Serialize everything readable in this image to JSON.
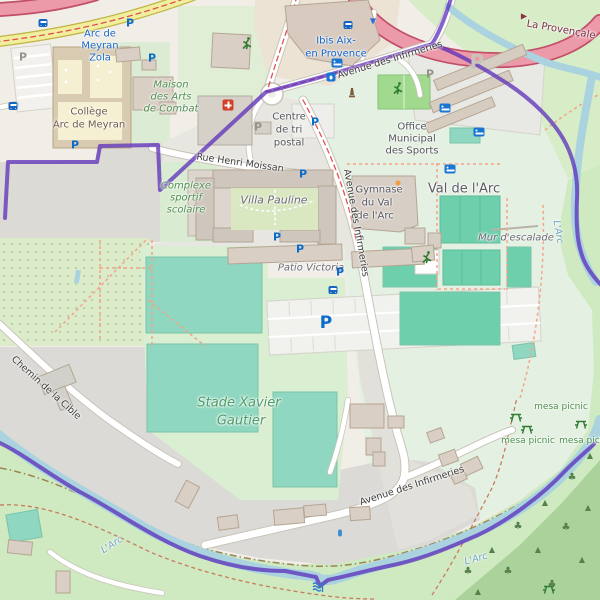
{
  "map": {
    "type": "openstreetmap-view",
    "colors": {
      "boundary_purple": "#5b2eba",
      "water_blue": "#aad3df",
      "pitch_teal": "#8fd7c0",
      "court_teal": "#6ecfac",
      "motorway_pink": "#ec9aa9",
      "secondary_yellow": "#f1ef9e",
      "grass_green": "#cfe9c1",
      "forest_green": "#abd29b",
      "paved_gray": "#dbdad6"
    },
    "labels": [
      {
        "name": "transit-stop-arc-de-meyran-1",
        "cls": "transit",
        "text": "Arc de",
        "x": 100,
        "y": 34
      },
      {
        "name": "transit-stop-arc-de-meyran-2",
        "cls": "transit",
        "text": "Meyran",
        "x": 100,
        "y": 46
      },
      {
        "name": "transit-stop-arc-de-meyran-3",
        "cls": "transit",
        "text": "Zola",
        "x": 100,
        "y": 58
      },
      {
        "name": "label-college-1",
        "cls": "poi",
        "text": "Collège",
        "x": 89,
        "y": 112
      },
      {
        "name": "label-college-2",
        "cls": "poi",
        "text": "Arc de Meyran",
        "x": 89,
        "y": 125
      },
      {
        "name": "label-maison-arts-1",
        "cls": "leisure",
        "text": "Maison",
        "x": 171,
        "y": 85
      },
      {
        "name": "label-maison-arts-2",
        "cls": "leisure",
        "text": "des Arts",
        "x": 171,
        "y": 97
      },
      {
        "name": "label-maison-arts-3",
        "cls": "leisure",
        "text": "de Combat",
        "x": 171,
        "y": 109
      },
      {
        "name": "label-hotel-ibis-1",
        "cls": "tourism",
        "text": "Ibis Aix-",
        "x": 336,
        "y": 41
      },
      {
        "name": "label-hotel-ibis-2",
        "cls": "tourism",
        "text": "en Provence",
        "x": 336,
        "y": 54
      },
      {
        "name": "street-avenue-infirmeries-north",
        "cls": "street",
        "text": "Avenue des Infirmeries",
        "x": 390,
        "y": 60,
        "rot": -17
      },
      {
        "name": "label-centre-tri-1",
        "cls": "place",
        "text": "Centre",
        "x": 289,
        "y": 117
      },
      {
        "name": "label-centre-tri-2",
        "cls": "place",
        "text": "de tri",
        "x": 289,
        "y": 130
      },
      {
        "name": "label-centre-tri-3",
        "cls": "place",
        "text": "postal",
        "x": 289,
        "y": 143
      },
      {
        "name": "label-office-sports-1",
        "cls": "place",
        "text": "Office",
        "x": 412,
        "y": 127
      },
      {
        "name": "label-office-sports-2",
        "cls": "place",
        "text": "Municipal",
        "x": 412,
        "y": 139
      },
      {
        "name": "label-office-sports-3",
        "cls": "place",
        "text": "des Sports",
        "x": 412,
        "y": 151
      },
      {
        "name": "street-rue-henri-moissan",
        "cls": "street",
        "text": "Rue Henri Moissan",
        "x": 240,
        "y": 163,
        "rot": 8
      },
      {
        "name": "label-complexe-1",
        "cls": "leisure",
        "text": "Complexe",
        "x": 186,
        "y": 186
      },
      {
        "name": "label-complexe-2",
        "cls": "leisure",
        "text": "sportif",
        "x": 186,
        "y": 198
      },
      {
        "name": "label-complexe-3",
        "cls": "leisure",
        "text": "scolaire",
        "x": 186,
        "y": 210
      },
      {
        "name": "label-villa-pauline",
        "cls": "residential",
        "text": "Villa Pauline",
        "x": 274,
        "y": 200,
        "size": 11
      },
      {
        "name": "label-gymnase-1",
        "cls": "place",
        "text": "Gymnase",
        "x": 379,
        "y": 190
      },
      {
        "name": "label-gymnase-2",
        "cls": "place",
        "text": "du Val",
        "x": 377,
        "y": 203
      },
      {
        "name": "label-gymnase-3",
        "cls": "place",
        "text": "de l'Arc",
        "x": 375,
        "y": 216
      },
      {
        "name": "label-val-de-larc",
        "cls": "district",
        "text": "Val de l'Arc",
        "x": 464,
        "y": 189
      },
      {
        "name": "label-mur-escalade",
        "cls": "residential",
        "text": "Mur d'escalade",
        "x": 516,
        "y": 238
      },
      {
        "name": "label-patio-victoria",
        "cls": "residential",
        "text": "Patio Victoria",
        "x": 311,
        "y": 268
      },
      {
        "name": "street-avenue-infirmeries-mid",
        "cls": "street",
        "text": "Avenue des Infirmeries",
        "x": 356,
        "y": 223,
        "rot": 80
      },
      {
        "name": "label-stade-1",
        "cls": "stade",
        "text": "Stade Xavier",
        "x": 239,
        "y": 403
      },
      {
        "name": "label-stade-2",
        "cls": "stade",
        "text": "Gautier",
        "x": 241,
        "y": 421
      },
      {
        "name": "label-picnic-1",
        "cls": "picnic",
        "text": "mesa picnic",
        "x": 561,
        "y": 407
      },
      {
        "name": "label-picnic-2",
        "cls": "picnic",
        "text": "mesa picnic",
        "x": 528,
        "y": 441
      },
      {
        "name": "label-picnic-3",
        "cls": "picnic",
        "text": "mesa picnic",
        "x": 586,
        "y": 441
      },
      {
        "name": "street-chemin-de-la-cible",
        "cls": "street",
        "text": "Chemin de la Cible",
        "x": 46,
        "y": 388,
        "rot": 42
      },
      {
        "name": "label-river-larc-1",
        "cls": "water",
        "text": "L'Arc",
        "x": 112,
        "y": 545,
        "rot": -33
      },
      {
        "name": "label-river-larc-2",
        "cls": "water",
        "text": "L'Arc",
        "x": 476,
        "y": 559,
        "rot": -16
      },
      {
        "name": "label-river-larc-3",
        "cls": "water",
        "text": "L'Arc",
        "x": 558,
        "y": 232,
        "rot": 80
      },
      {
        "name": "street-avenue-infirmeries-south",
        "cls": "street",
        "text": "Avenue des Infirmeries",
        "x": 412,
        "y": 486,
        "rot": -18
      },
      {
        "name": "street-la-provencale",
        "cls": "motorway",
        "text": "La Provençale",
        "x": 561,
        "y": 30,
        "rot": 10
      }
    ],
    "icons": [
      {
        "name": "parking-icon",
        "type": "p",
        "x": 130,
        "y": 23
      },
      {
        "name": "parking-icon",
        "type": "p",
        "x": 152,
        "y": 58
      },
      {
        "name": "parking-icon",
        "type": "p",
        "x": 75,
        "y": 145
      },
      {
        "name": "parking-icon",
        "type": "p",
        "x": 315,
        "y": 122
      },
      {
        "name": "parking-icon",
        "type": "p",
        "x": 303,
        "y": 174
      },
      {
        "name": "parking-icon",
        "type": "p",
        "x": 277,
        "y": 237
      },
      {
        "name": "parking-icon",
        "type": "p",
        "x": 300,
        "y": 249
      },
      {
        "name": "parking-icon",
        "type": "p",
        "x": 340,
        "y": 272
      },
      {
        "name": "parking-icon-large",
        "type": "p-big",
        "x": 326,
        "y": 323
      },
      {
        "name": "parking-icon-gray",
        "type": "p-gray",
        "x": 23,
        "y": 57
      },
      {
        "name": "parking-icon-gray",
        "type": "p-gray",
        "x": 258,
        "y": 127
      },
      {
        "name": "parking-icon-gray",
        "type": "p-gray",
        "x": 430,
        "y": 74
      },
      {
        "name": "parking-icon-pale",
        "type": "p-pale",
        "x": 477,
        "y": 62
      },
      {
        "name": "bus-stop-icon",
        "type": "bus",
        "x": 43,
        "y": 23
      },
      {
        "name": "bus-stop-icon",
        "type": "bus",
        "x": 13,
        "y": 98
      },
      {
        "name": "bus-stop-icon",
        "type": "bus",
        "x": 348,
        "y": 9
      },
      {
        "name": "bus-stop-icon",
        "type": "bus",
        "x": 333,
        "y": 266
      },
      {
        "name": "hotel-icon",
        "type": "bed",
        "x": 337,
        "y": 31
      },
      {
        "name": "shelter-icon",
        "type": "bed",
        "x": 445,
        "y": 67
      },
      {
        "name": "shelter-icon",
        "type": "bed",
        "x": 479,
        "y": 82
      },
      {
        "name": "shelter-icon",
        "type": "bed",
        "x": 450,
        "y": 110
      },
      {
        "name": "drinking-fountain-icon",
        "type": "fountain",
        "x": 331,
        "y": 9
      },
      {
        "name": "first-aid-icon",
        "type": "firstaid",
        "x": 228,
        "y": 28
      },
      {
        "name": "runner-icon",
        "type": "runner",
        "x": 247,
        "y": 43
      },
      {
        "name": "runner-icon",
        "type": "runner",
        "x": 398,
        "y": 88
      },
      {
        "name": "runner-icon",
        "type": "runner",
        "x": 427,
        "y": 257
      },
      {
        "name": "monument-icon",
        "type": "monument",
        "x": 352,
        "y": 93
      },
      {
        "name": "picnic-table-icon",
        "type": "picnic",
        "x": 516,
        "y": 417
      },
      {
        "name": "picnic-table-icon",
        "type": "picnic",
        "x": 527,
        "y": 429
      },
      {
        "name": "picnic-table-icon",
        "type": "picnic",
        "x": 581,
        "y": 424
      },
      {
        "name": "picnic-table-icon",
        "type": "picnic",
        "x": 549,
        "y": 589
      },
      {
        "name": "weir-icon",
        "type": "weir",
        "x": 318,
        "y": 587
      },
      {
        "name": "sports-centre-dot-icon",
        "type": "orange-dot",
        "x": 398,
        "y": 183
      },
      {
        "name": "oneway-arrow-icon",
        "type": "arrow-down",
        "x": 373,
        "y": 21,
        "glyph": "▼"
      },
      {
        "name": "oneway-arrow-icon",
        "type": "arrow-red",
        "x": 524,
        "y": 16,
        "glyph": "▶"
      },
      {
        "name": "water-point-icon",
        "type": "droplet",
        "x": 340,
        "y": 533
      },
      {
        "name": "tree-icon",
        "type": "tree-b",
        "x": 468,
        "y": 572,
        "glyph": "♣"
      },
      {
        "name": "tree-icon",
        "type": "tree-c",
        "x": 492,
        "y": 550,
        "glyph": "▲"
      },
      {
        "name": "tree-icon",
        "type": "tree-b",
        "x": 518,
        "y": 527,
        "glyph": "♣"
      },
      {
        "name": "tree-icon",
        "type": "tree-c",
        "x": 545,
        "y": 503,
        "glyph": "▲"
      },
      {
        "name": "tree-icon",
        "type": "tree-b",
        "x": 572,
        "y": 478,
        "glyph": "♣"
      },
      {
        "name": "tree-icon",
        "type": "tree-c",
        "x": 590,
        "y": 456,
        "glyph": "▲"
      },
      {
        "name": "tree-icon",
        "type": "tree-c",
        "x": 478,
        "y": 592,
        "glyph": "▲"
      },
      {
        "name": "tree-icon",
        "type": "tree-b",
        "x": 508,
        "y": 572,
        "glyph": "♣"
      },
      {
        "name": "tree-icon",
        "type": "tree-c",
        "x": 538,
        "y": 550,
        "glyph": "▲"
      },
      {
        "name": "tree-icon",
        "type": "tree-b",
        "x": 566,
        "y": 528,
        "glyph": "♣"
      },
      {
        "name": "tree-icon",
        "type": "tree-c",
        "x": 588,
        "y": 508,
        "glyph": "▲"
      },
      {
        "name": "tree-icon",
        "type": "tree-b",
        "x": 552,
        "y": 585,
        "glyph": "♣"
      },
      {
        "name": "tree-icon",
        "type": "tree-c",
        "x": 582,
        "y": 560,
        "glyph": "▲"
      }
    ]
  }
}
